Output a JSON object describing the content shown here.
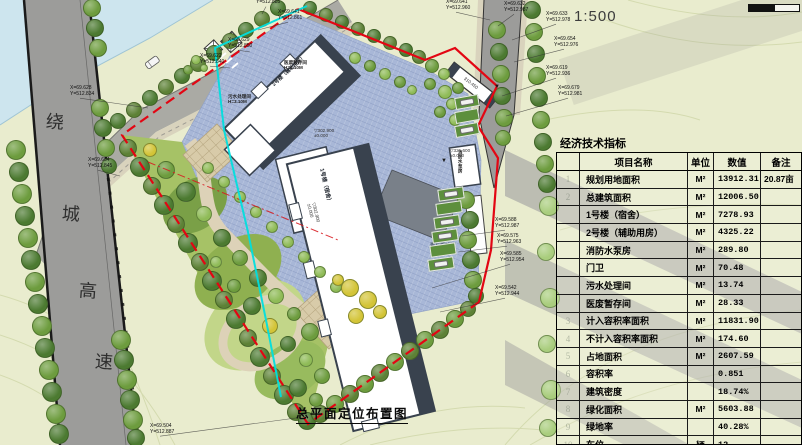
{
  "title_block": {
    "drawing_title": "总平面定位布置图",
    "scale_label": "1:500"
  },
  "table": {
    "title": "经济技术指标",
    "headers": {
      "num": "",
      "name": "项目名称",
      "unit": "单位",
      "value": "数值",
      "note": "备注"
    },
    "rows": [
      {
        "num": "1",
        "name": "规划用地面积",
        "unit": "M²",
        "value": "13912.31",
        "note": "20.87亩"
      },
      {
        "num": "2",
        "name": "总建筑面积",
        "unit": "M²",
        "value": "12006.50",
        "note": ""
      },
      {
        "num": "",
        "name": "1号楼（宿舍）",
        "unit": "M²",
        "value": "7278.93",
        "note": ""
      },
      {
        "num": "",
        "name": "2号楼（辅助用房）",
        "unit": "M²",
        "value": "4325.22",
        "note": ""
      },
      {
        "num": "",
        "name": "消防水泵房",
        "unit": "M²",
        "value": "289.80",
        "note": ""
      },
      {
        "num": "",
        "name": "门卫",
        "unit": "M²",
        "value": "70.48",
        "note": ""
      },
      {
        "num": "",
        "name": "污水处理间",
        "unit": "M²",
        "value": "13.74",
        "note": ""
      },
      {
        "num": "",
        "name": "医废暂存间",
        "unit": "M²",
        "value": "28.33",
        "note": ""
      },
      {
        "num": "3",
        "name": "计入容积率面积",
        "unit": "M²",
        "value": "11831.90",
        "note": ""
      },
      {
        "num": "4",
        "name": "不计入容积率面积",
        "unit": "M²",
        "value": "174.60",
        "note": ""
      },
      {
        "num": "5",
        "name": "占地面积",
        "unit": "M²",
        "value": "2607.59",
        "note": ""
      },
      {
        "num": "6",
        "name": "容积率",
        "unit": "",
        "value": "0.851",
        "note": ""
      },
      {
        "num": "7",
        "name": "建筑密度",
        "unit": "",
        "value": "18.74%",
        "note": ""
      },
      {
        "num": "8",
        "name": "绿化面积",
        "unit": "M²",
        "value": "5603.88",
        "note": ""
      },
      {
        "num": "9",
        "name": "绿地率",
        "unit": "",
        "value": "40.28%",
        "note": ""
      },
      {
        "num": "10",
        "name": "车位",
        "unit": "辆",
        "value": "12",
        "note": ""
      }
    ]
  },
  "road_labels": {
    "highway_chars": [
      "绕",
      "城",
      "高",
      "速"
    ]
  },
  "plan": {
    "coord_labels": [
      {
        "x": 256,
        "y": 0,
        "lines": [
          "Y=512.885"
        ],
        "tx": 262,
        "ty": 14
      },
      {
        "x": 278,
        "y": 10,
        "lines": [
          "X=69.641",
          "Y=512.861"
        ],
        "tx": 258,
        "ty": 30
      },
      {
        "x": 228,
        "y": 38,
        "lines": [
          "X=69.629",
          "Y=512.850"
        ],
        "tx": 250,
        "ty": 52
      },
      {
        "x": 200,
        "y": 54,
        "lines": [
          "X=69.622",
          "Y=512.840"
        ],
        "tx": 230,
        "ty": 68
      },
      {
        "x": 70,
        "y": 86,
        "lines": [
          "X=69.628",
          "Y=512.834"
        ],
        "tx": 148,
        "ty": 108
      },
      {
        "x": 88,
        "y": 158,
        "lines": [
          "X=69.604",
          "Y=512.845"
        ],
        "tx": 120,
        "ty": 176
      },
      {
        "x": 446,
        "y": 0,
        "lines": [
          "X=69.641",
          "Y=512.960"
        ],
        "tx": 490,
        "ty": 20
      },
      {
        "x": 504,
        "y": 2,
        "lines": [
          "X=69.632",
          "Y=512.987"
        ],
        "tx": 498,
        "ty": 26
      },
      {
        "x": 546,
        "y": 12,
        "lines": [
          "X=69.633",
          "Y=512.978"
        ],
        "tx": 512,
        "ty": 40
      },
      {
        "x": 554,
        "y": 37,
        "lines": [
          "X=69.654",
          "Y=512.976"
        ],
        "tx": 514,
        "ty": 62
      },
      {
        "x": 546,
        "y": 66,
        "lines": [
          "X=69.619",
          "Y=512.936"
        ],
        "tx": 502,
        "ty": 96
      },
      {
        "x": 558,
        "y": 86,
        "lines": [
          "X=69.679",
          "Y=512.981"
        ],
        "tx": 506,
        "ty": 116
      },
      {
        "x": 495,
        "y": 218,
        "lines": [
          "X=69.588",
          "Y=512.987"
        ],
        "tx": 462,
        "ty": 236
      },
      {
        "x": 497,
        "y": 234,
        "lines": [
          "X=69.575",
          "Y=512.963"
        ],
        "tx": 458,
        "ty": 252
      },
      {
        "x": 500,
        "y": 252,
        "lines": [
          "X=69.585",
          "Y=512.954"
        ],
        "tx": 432,
        "ty": 288
      },
      {
        "x": 495,
        "y": 286,
        "lines": [
          "X=69.542",
          "Y=512.944"
        ],
        "tx": 440,
        "ty": 312
      },
      {
        "x": 150,
        "y": 424,
        "lines": [
          "X=69.504",
          "Y=512.887"
        ],
        "tx": 296,
        "ty": 418
      }
    ],
    "level_marks": [
      {
        "x": 314,
        "y": 128,
        "lines": [
          "▽302.900",
          "±0.000"
        ],
        "rot": 0
      },
      {
        "x": 316,
        "y": 202,
        "lines": [
          "▽302.900",
          "±0.000"
        ],
        "rot": 76
      },
      {
        "x": 450,
        "y": 148,
        "lines": [
          "▽321.600",
          "±0.000"
        ],
        "rot": 0
      },
      {
        "x": 466,
        "y": 76,
        "lines": [
          "310.450"
        ],
        "rot": 38
      }
    ],
    "marks": [
      {
        "x": 441,
        "y": 158,
        "t": "▼"
      },
      {
        "x": 494,
        "y": 84,
        "t": "▼"
      }
    ],
    "building_labels": [
      {
        "lines": [
          "2号楼（辅助用房）"
        ],
        "x": 272,
        "y": 84,
        "rot": -43,
        "size": 5,
        "c": "#1d232c"
      },
      {
        "lines": [
          "1号楼（宿舍）"
        ],
        "x": 324,
        "y": 168,
        "rot": 77,
        "size": 5.5,
        "c": "#1d232c"
      },
      {
        "lines": [
          "医废暂存间",
          "H=3.10M"
        ],
        "x": 284,
        "y": 60,
        "rot": 0,
        "size": 4.6,
        "c": "#222"
      },
      {
        "lines": [
          "污水处理间",
          "H=3.10M"
        ],
        "x": 228,
        "y": 94,
        "rot": 0,
        "size": 4.6,
        "c": "#222"
      },
      {
        "lines": [
          "消防水泵房"
        ],
        "x": 458,
        "y": 150,
        "rot": 0,
        "size": 4.6,
        "c": "#222",
        "vert": true
      },
      {
        "lines": [
          "青石板铺装"
        ],
        "x": 430,
        "y": 244,
        "rot": 0,
        "size": 5,
        "c": "#4a5568"
      }
    ],
    "trees": [
      [
        16,
        150,
        10,
        "m"
      ],
      [
        19,
        172,
        10,
        "d"
      ],
      [
        22,
        194,
        10,
        "m"
      ],
      [
        25,
        216,
        10,
        "d"
      ],
      [
        28,
        238,
        10,
        "m"
      ],
      [
        31,
        260,
        10,
        "d"
      ],
      [
        35,
        282,
        10,
        "m"
      ],
      [
        38,
        304,
        10,
        "d"
      ],
      [
        42,
        326,
        10,
        "m"
      ],
      [
        45,
        348,
        10,
        "d"
      ],
      [
        49,
        370,
        10,
        "m"
      ],
      [
        52,
        392,
        10,
        "d"
      ],
      [
        56,
        414,
        10,
        "m"
      ],
      [
        59,
        434,
        10,
        "d"
      ],
      [
        92,
        8,
        9,
        "m"
      ],
      [
        95,
        28,
        9,
        "d"
      ],
      [
        98,
        48,
        9,
        "m"
      ],
      [
        100,
        108,
        9,
        "m"
      ],
      [
        103,
        128,
        9,
        "d"
      ],
      [
        106,
        148,
        9,
        "m"
      ],
      [
        109,
        166,
        8,
        "d"
      ],
      [
        121,
        340,
        10,
        "m"
      ],
      [
        124,
        360,
        10,
        "d"
      ],
      [
        127,
        380,
        10,
        "m"
      ],
      [
        130,
        400,
        10,
        "d"
      ],
      [
        133,
        420,
        10,
        "m"
      ],
      [
        136,
        438,
        9,
        "d"
      ],
      [
        118,
        121,
        8,
        "d"
      ],
      [
        134,
        110,
        8,
        "o"
      ],
      [
        150,
        98,
        8,
        "d"
      ],
      [
        166,
        87,
        8,
        "o"
      ],
      [
        182,
        76,
        8,
        "d"
      ],
      [
        198,
        64,
        8,
        "o"
      ],
      [
        214,
        53,
        8,
        "d"
      ],
      [
        230,
        41,
        8,
        "o"
      ],
      [
        246,
        30,
        8,
        "d"
      ],
      [
        262,
        19,
        8,
        "o"
      ],
      [
        278,
        8,
        8,
        "d"
      ],
      [
        310,
        8,
        7,
        "d"
      ],
      [
        326,
        15,
        7,
        "o"
      ],
      [
        342,
        22,
        7,
        "d"
      ],
      [
        358,
        29,
        7,
        "o"
      ],
      [
        374,
        36,
        7,
        "d"
      ],
      [
        390,
        43,
        7,
        "o"
      ],
      [
        406,
        50,
        7,
        "d"
      ],
      [
        419,
        57,
        7,
        "o"
      ],
      [
        432,
        66,
        7,
        "m"
      ],
      [
        444,
        74,
        6,
        "l"
      ],
      [
        430,
        84,
        6,
        "m"
      ],
      [
        445,
        92,
        7,
        "l"
      ],
      [
        458,
        88,
        6,
        "m"
      ],
      [
        452,
        104,
        6,
        "l"
      ],
      [
        440,
        112,
        6,
        "m"
      ],
      [
        455,
        120,
        6,
        "l"
      ],
      [
        466,
        200,
        9,
        "m"
      ],
      [
        470,
        220,
        9,
        "d"
      ],
      [
        468,
        240,
        9,
        "m"
      ],
      [
        471,
        260,
        9,
        "d"
      ],
      [
        473,
        280,
        9,
        "m"
      ],
      [
        476,
        296,
        8,
        "d"
      ],
      [
        497,
        30,
        9,
        "m"
      ],
      [
        499,
        52,
        9,
        "d"
      ],
      [
        501,
        74,
        9,
        "m"
      ],
      [
        502,
        96,
        9,
        "d"
      ],
      [
        504,
        118,
        9,
        "m"
      ],
      [
        503,
        138,
        8,
        "m"
      ],
      [
        532,
        10,
        9,
        "d"
      ],
      [
        534,
        32,
        9,
        "m"
      ],
      [
        536,
        54,
        9,
        "d"
      ],
      [
        537,
        76,
        9,
        "m"
      ],
      [
        539,
        98,
        9,
        "d"
      ],
      [
        541,
        120,
        9,
        "m"
      ],
      [
        543,
        142,
        9,
        "d"
      ],
      [
        545,
        164,
        9,
        "m"
      ],
      [
        547,
        184,
        9,
        "d"
      ],
      [
        549,
        206,
        10,
        "p"
      ],
      [
        546,
        252,
        9,
        "p"
      ],
      [
        550,
        298,
        10,
        "p"
      ],
      [
        547,
        344,
        9,
        "p"
      ],
      [
        551,
        390,
        10,
        "p"
      ],
      [
        548,
        428,
        9,
        "p"
      ],
      [
        128,
        148,
        9,
        "o"
      ],
      [
        140,
        167,
        10,
        "d"
      ],
      [
        152,
        186,
        9,
        "o"
      ],
      [
        164,
        205,
        10,
        "d"
      ],
      [
        176,
        224,
        9,
        "o"
      ],
      [
        188,
        243,
        10,
        "d"
      ],
      [
        200,
        262,
        9,
        "o"
      ],
      [
        212,
        281,
        10,
        "d"
      ],
      [
        224,
        300,
        9,
        "o"
      ],
      [
        236,
        319,
        10,
        "d"
      ],
      [
        248,
        338,
        9,
        "o"
      ],
      [
        260,
        357,
        10,
        "d"
      ],
      [
        272,
        376,
        9,
        "o"
      ],
      [
        284,
        395,
        10,
        "d"
      ],
      [
        296,
        412,
        9,
        "o"
      ],
      [
        307,
        421,
        9,
        "d"
      ],
      [
        320,
        414,
        9,
        "o"
      ],
      [
        335,
        404,
        9,
        "m"
      ],
      [
        350,
        394,
        9,
        "o"
      ],
      [
        365,
        384,
        9,
        "m"
      ],
      [
        380,
        373,
        9,
        "o"
      ],
      [
        395,
        362,
        9,
        "m"
      ],
      [
        410,
        351,
        9,
        "o"
      ],
      [
        425,
        340,
        9,
        "m"
      ],
      [
        440,
        330,
        9,
        "o"
      ],
      [
        455,
        319,
        9,
        "m"
      ],
      [
        468,
        309,
        8,
        "o"
      ],
      [
        150,
        150,
        7,
        "y"
      ],
      [
        166,
        170,
        9,
        "m"
      ],
      [
        186,
        192,
        10,
        "d"
      ],
      [
        204,
        214,
        8,
        "l"
      ],
      [
        222,
        238,
        9,
        "d"
      ],
      [
        240,
        258,
        8,
        "m"
      ],
      [
        216,
        262,
        6,
        "l"
      ],
      [
        258,
        278,
        9,
        "d"
      ],
      [
        234,
        286,
        7,
        "m"
      ],
      [
        276,
        296,
        8,
        "l"
      ],
      [
        252,
        306,
        9,
        "d"
      ],
      [
        294,
        314,
        7,
        "m"
      ],
      [
        270,
        326,
        8,
        "y"
      ],
      [
        310,
        332,
        9,
        "m"
      ],
      [
        288,
        344,
        8,
        "d"
      ],
      [
        306,
        360,
        7,
        "l"
      ],
      [
        322,
        376,
        8,
        "m"
      ],
      [
        298,
        388,
        9,
        "d"
      ],
      [
        316,
        400,
        7,
        "m"
      ],
      [
        208,
        168,
        6,
        "l"
      ],
      [
        224,
        182,
        6,
        "l"
      ],
      [
        240,
        197,
        6,
        "l"
      ],
      [
        256,
        212,
        6,
        "l"
      ],
      [
        272,
        227,
        6,
        "l"
      ],
      [
        288,
        242,
        6,
        "l"
      ],
      [
        304,
        257,
        6,
        "l"
      ],
      [
        320,
        272,
        6,
        "l"
      ],
      [
        336,
        287,
        6,
        "l"
      ],
      [
        350,
        288,
        9,
        "y"
      ],
      [
        368,
        300,
        9,
        "y"
      ],
      [
        356,
        316,
        8,
        "y"
      ],
      [
        380,
        312,
        7,
        "y"
      ],
      [
        338,
        280,
        6,
        "y"
      ],
      [
        196,
        60,
        5,
        "l"
      ],
      [
        188,
        70,
        5,
        "m"
      ],
      [
        204,
        68,
        4,
        "l"
      ],
      [
        355,
        58,
        6,
        "l"
      ],
      [
        370,
        66,
        6,
        "m"
      ],
      [
        385,
        74,
        6,
        "l"
      ],
      [
        400,
        82,
        6,
        "m"
      ],
      [
        412,
        90,
        5,
        "l"
      ]
    ],
    "parking_stalls": [
      [
        455,
        96,
        24,
        12,
        -10,
        1
      ],
      [
        455,
        110,
        24,
        12,
        -10,
        0
      ],
      [
        455,
        124,
        24,
        12,
        -10,
        1
      ],
      [
        438,
        188,
        26,
        12,
        -8,
        1
      ],
      [
        436,
        202,
        26,
        12,
        -8,
        0
      ],
      [
        434,
        216,
        26,
        12,
        -8,
        1
      ],
      [
        432,
        230,
        26,
        12,
        -8,
        1
      ],
      [
        430,
        244,
        26,
        12,
        -8,
        0
      ],
      [
        428,
        258,
        26,
        12,
        -8,
        1
      ]
    ]
  },
  "colors": {
    "background": "#e9ecce",
    "water": "#cde5ee",
    "highway": "#9c9c9a",
    "paving": "#a8b7d7",
    "boundary_red": "#e30613",
    "utility_cyan": "#00dede",
    "lawn": "#a6c266",
    "building_wall": "#39424e"
  }
}
